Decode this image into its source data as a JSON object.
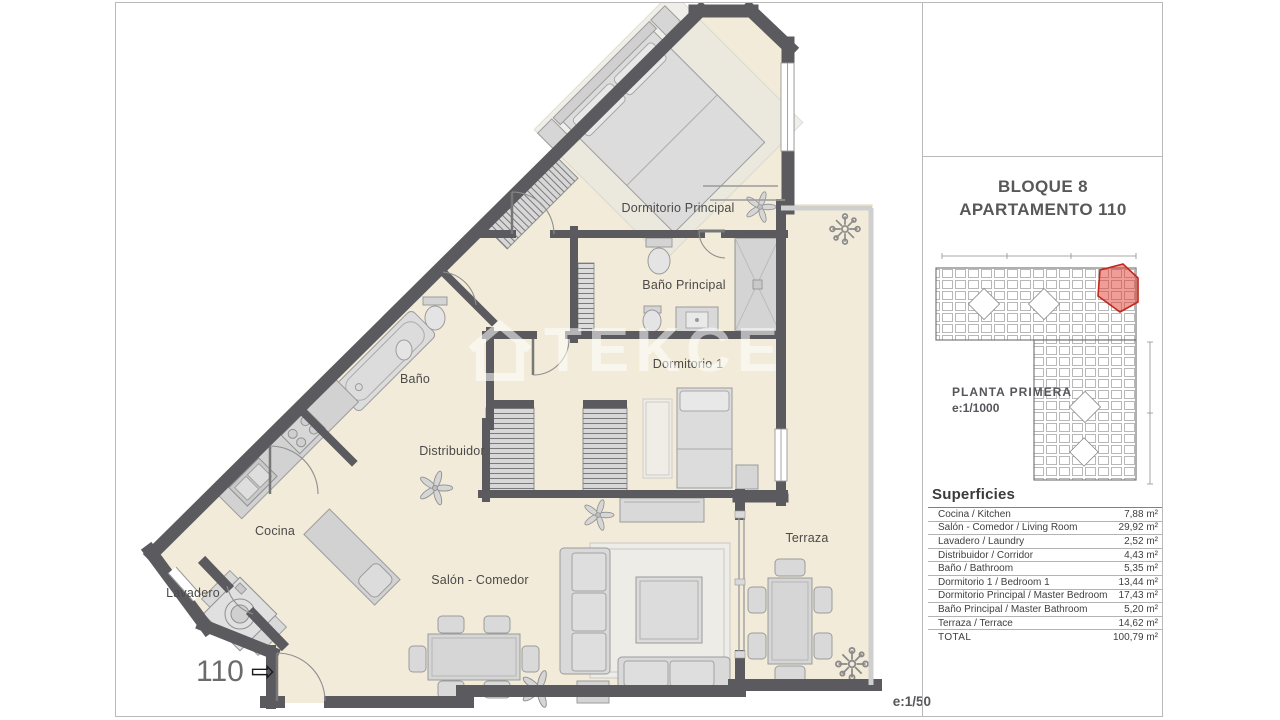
{
  "plan": {
    "apartment_number": "110",
    "entrance_arrow": "⇨",
    "scale_label": "e:1/50",
    "watermark_text": "TEKCE",
    "rooms": [
      {
        "id": "dormitorio-principal",
        "label": "Dormitorio Principal"
      },
      {
        "id": "bano-principal",
        "label": "Baño Principal"
      },
      {
        "id": "dormitorio-1",
        "label": "Dormitorio 1"
      },
      {
        "id": "bano",
        "label": "Baño"
      },
      {
        "id": "distribuidor",
        "label": "Distribuidor"
      },
      {
        "id": "cocina",
        "label": "Cocina"
      },
      {
        "id": "lavadero",
        "label": "Lavadero"
      },
      {
        "id": "salon-comedor",
        "label": "Salón - Comedor"
      },
      {
        "id": "terraza",
        "label": "Terraza"
      }
    ]
  },
  "panel": {
    "title_line1": "BLOQUE 8",
    "title_line2": "APARTAMENTO 110",
    "site_plan": {
      "floor_label": "PLANTA PRIMERA",
      "scale_label": "e:1/1000"
    },
    "surfaces": {
      "heading": "Superficies",
      "rows": [
        {
          "label": "Cocina / Kitchen",
          "value": "7,88 m²"
        },
        {
          "label": "Salón - Comedor / Living Room",
          "value": "29,92 m²"
        },
        {
          "label": "Lavadero / Laundry",
          "value": "2,52 m²"
        },
        {
          "label": "Distribuidor / Corridor",
          "value": "4,43 m²"
        },
        {
          "label": "Baño / Bathroom",
          "value": "5,35 m²"
        },
        {
          "label": "Dormitorio 1 / Bedroom 1",
          "value": "13,44 m²"
        },
        {
          "label": "Dormitorio Principal / Master Bedroom",
          "value": "17,43 m²"
        },
        {
          "label": "Baño Principal / Master Bathroom",
          "value": "5,20 m²"
        },
        {
          "label": "Terraza / Terrace",
          "value": "14,62 m²"
        },
        {
          "label": "TOTAL",
          "value": "100,79 m²",
          "is_total": true
        }
      ]
    }
  },
  "colors": {
    "wall": "#5b5b5f",
    "floor": "#f2ebd9",
    "furniture": "#d9d9d9",
    "railing": "#cfcfcf",
    "highlight_red": "#cc2a1e",
    "text": "#4a4a4a"
  }
}
